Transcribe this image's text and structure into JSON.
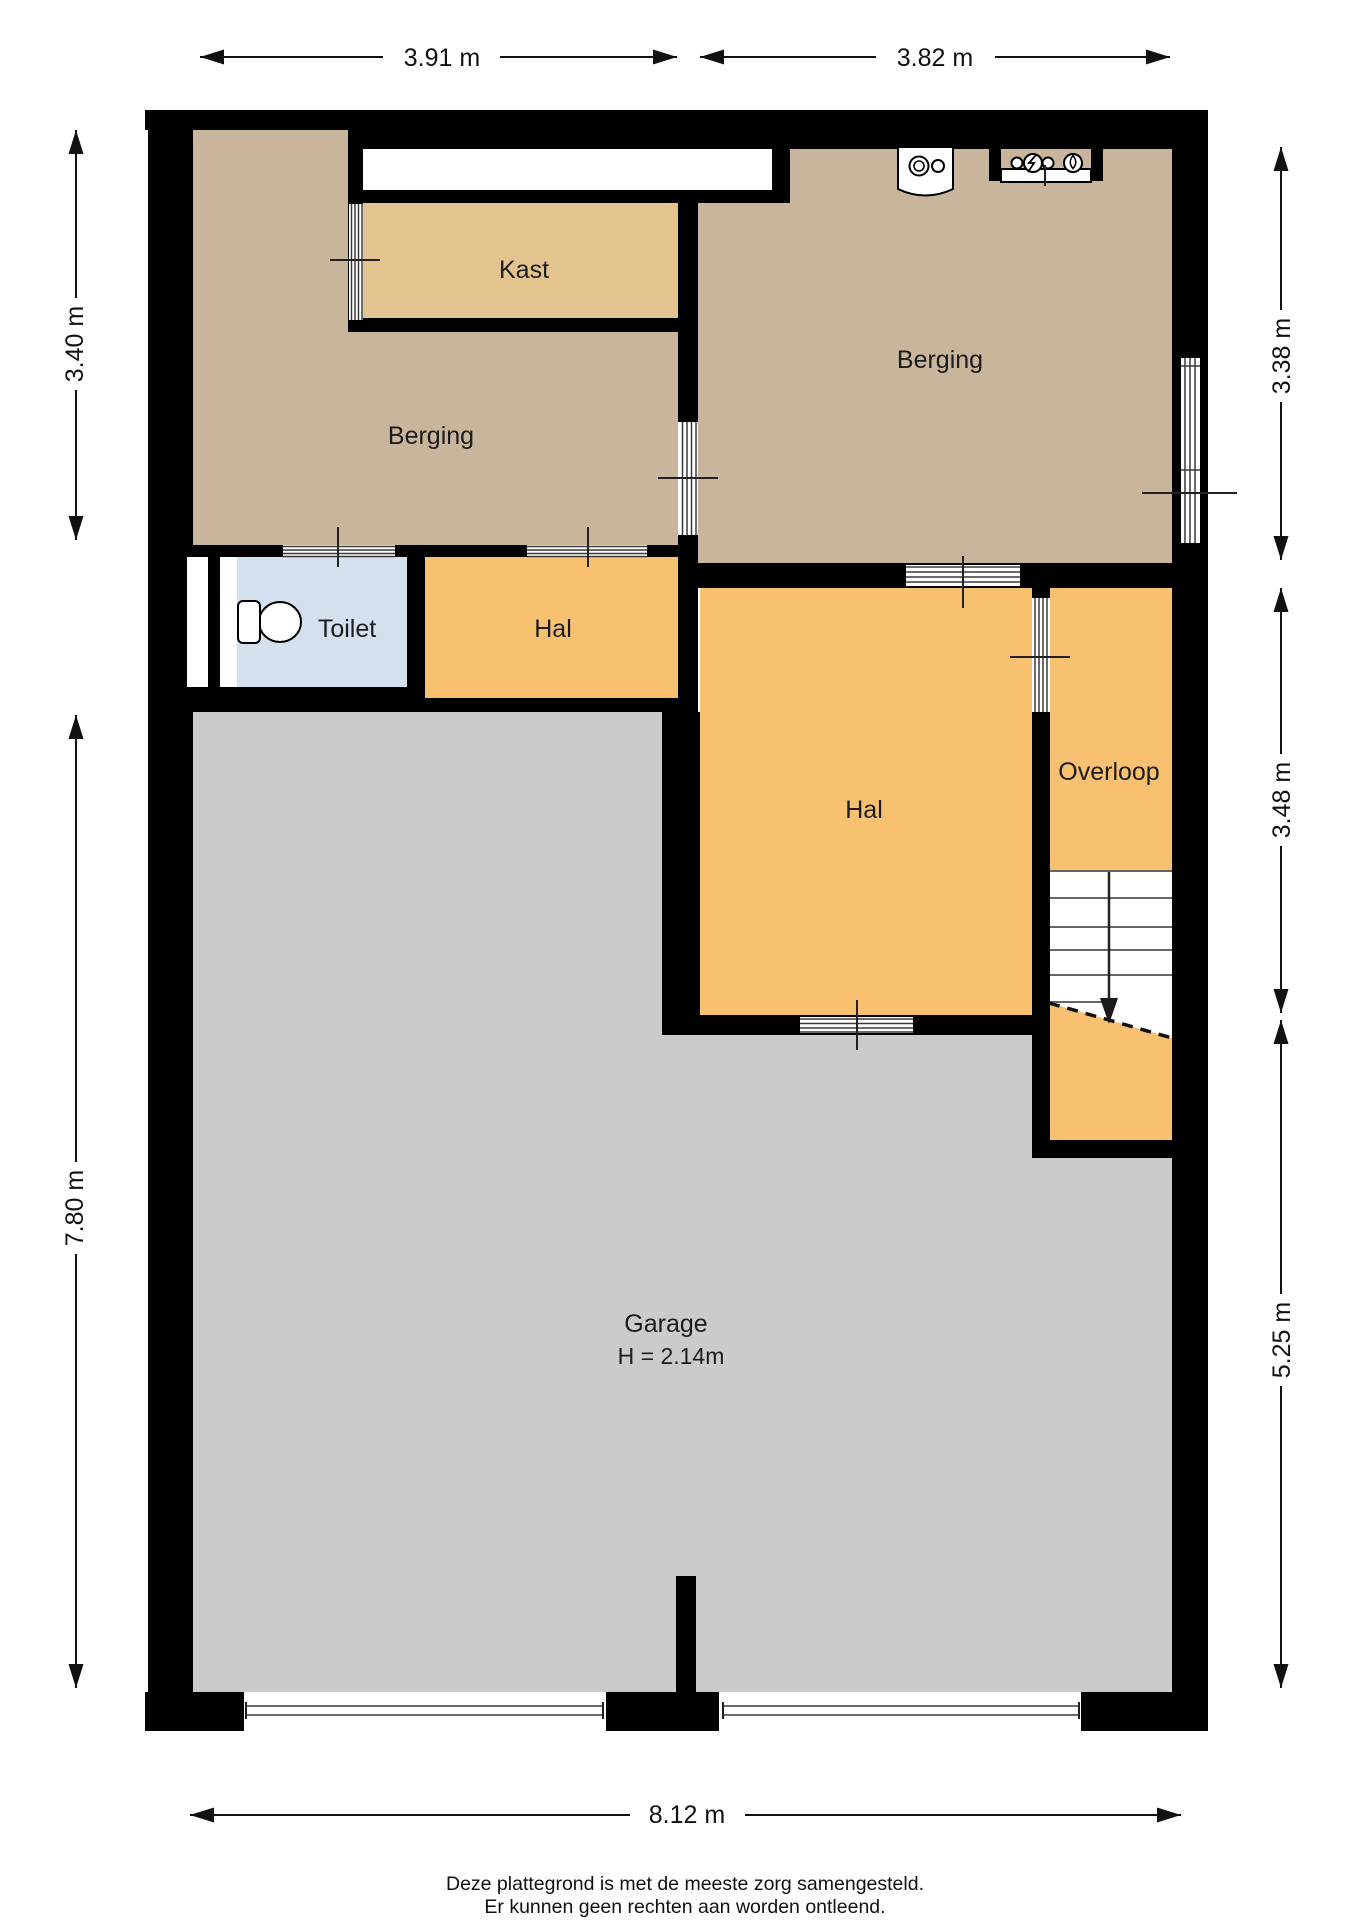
{
  "plan": {
    "rooms": [
      {
        "id": "kast",
        "label": "Kast"
      },
      {
        "id": "berging-left",
        "label": "Berging"
      },
      {
        "id": "berging-right",
        "label": "Berging"
      },
      {
        "id": "toilet",
        "label": "Toilet"
      },
      {
        "id": "hal-small",
        "label": "Hal"
      },
      {
        "id": "hal-large",
        "label": "Hal"
      },
      {
        "id": "overloop",
        "label": "Overloop"
      },
      {
        "id": "garage",
        "label": "Garage",
        "sublabel": "H = 2.14m"
      }
    ],
    "dimensions": {
      "top_left": "3.91 m",
      "top_right": "3.82 m",
      "left_upper": "3.40 m",
      "left_lower": "7.80 m",
      "right_upper": "3.38 m",
      "right_middle": "3.48 m",
      "right_lower": "5.25 m",
      "bottom": "8.12 m"
    },
    "footer_line1": "Deze plattegrond is met de meeste zorg samengesteld.",
    "footer_line2": "Er kunnen geen rechten aan worden ontleend."
  },
  "colors": {
    "wall": "#000000",
    "berging": "#c9b49c",
    "kast": "#e3c48e",
    "hal": "#f8c171",
    "toilet": "#d4e0ed",
    "garage": "#cbcbcb",
    "stairs": "#ffffff",
    "niche": "#ffffff"
  },
  "icons": {
    "toilet": "toilet-icon",
    "boiler": "boiler-icon",
    "utility_meters": "utility-meters-icon",
    "stairs": "stairs-icon",
    "stairs_arrow": "stairs-down-arrow-icon",
    "window": "window-symbol"
  }
}
